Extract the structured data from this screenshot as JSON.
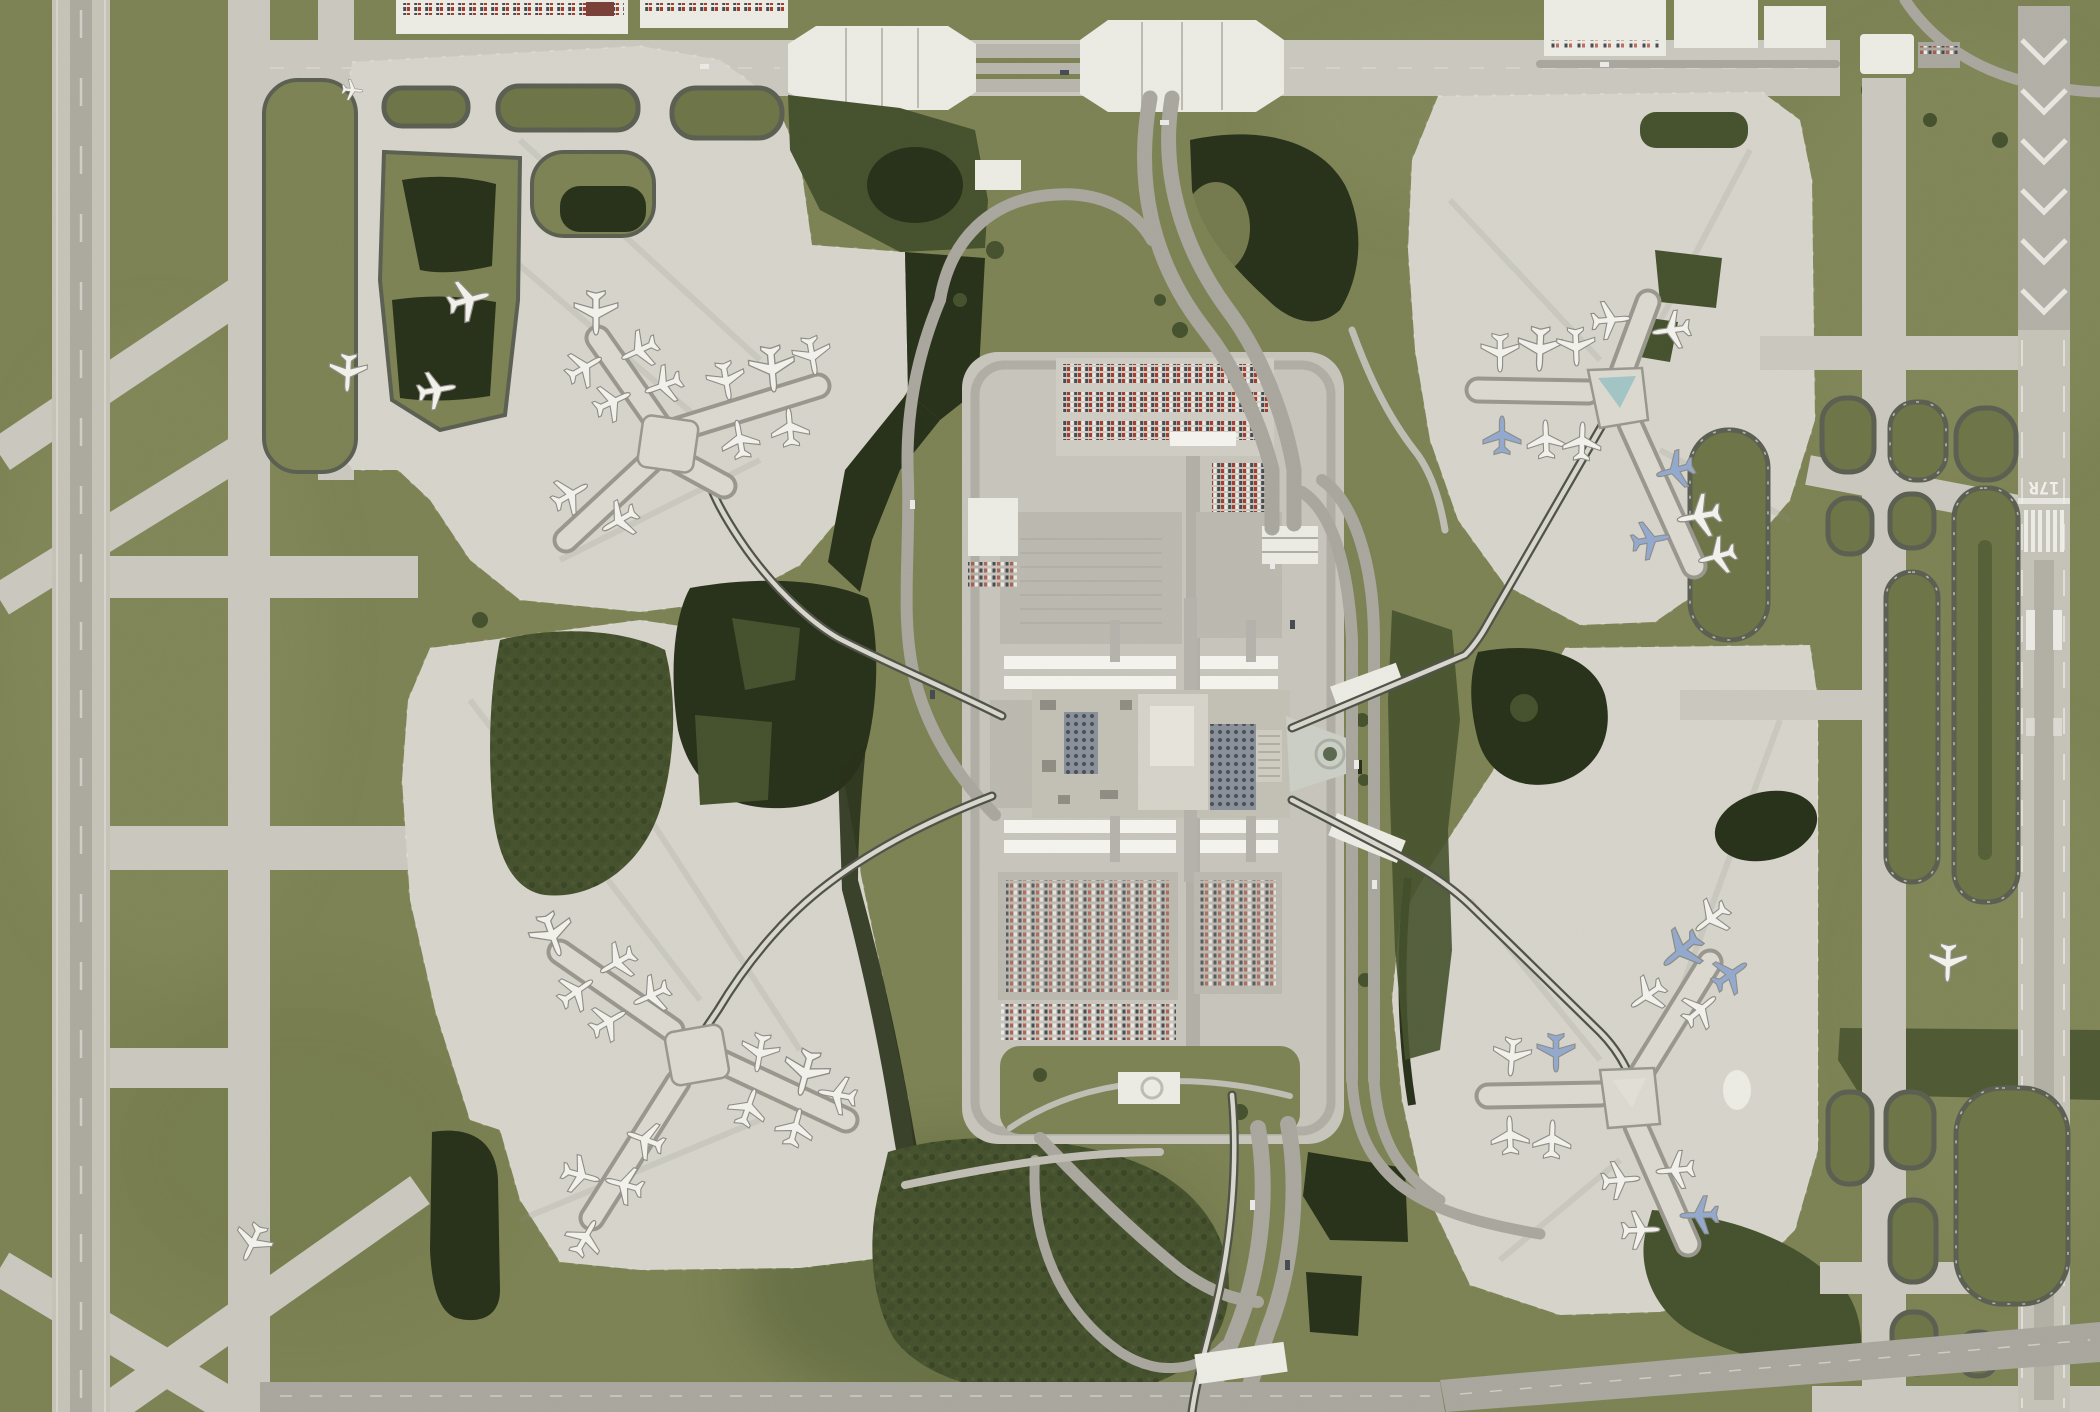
{
  "meta": {
    "title": "Satellite orthophoto — large hub airport",
    "type": "aerial-photograph",
    "description": "Top-down satellite view of an international airport: central landside terminal with parking garages, four satellite airside concourses linked by automated people-mover bridges, parallel north-south runways on the west and east sides, taxiway loops, retention ponds and tree stands."
  },
  "markings": {
    "runway_number_right": "17R"
  },
  "scene": {
    "airside_concourses": 4,
    "monorail_lines": 4,
    "runways_visible": 2,
    "aircraft_visible": 57,
    "features": [
      {
        "name": "runway-west",
        "kind": "runway"
      },
      {
        "name": "runway-east-17R",
        "kind": "runway"
      },
      {
        "name": "taxiway-network-west",
        "kind": "taxiways"
      },
      {
        "name": "taxiway-network-east",
        "kind": "taxiways"
      },
      {
        "name": "airside-northwest",
        "kind": "concourse"
      },
      {
        "name": "airside-northeast",
        "kind": "concourse"
      },
      {
        "name": "airside-southwest",
        "kind": "concourse"
      },
      {
        "name": "airside-southeast",
        "kind": "concourse"
      },
      {
        "name": "central-terminal",
        "kind": "terminal"
      },
      {
        "name": "parking-garages",
        "kind": "parking"
      },
      {
        "name": "rental-car-lots",
        "kind": "parking"
      },
      {
        "name": "taxiway-bridges-north",
        "kind": "bridge"
      },
      {
        "name": "south-access-highway",
        "kind": "road"
      },
      {
        "name": "retention-ponds",
        "kind": "water"
      },
      {
        "name": "tree-stands",
        "kind": "vegetation"
      },
      {
        "name": "cargo-aprons-north",
        "kind": "apron"
      }
    ]
  },
  "palette": {
    "grass": "#7d8354",
    "grass-light": "#8b9162",
    "grass-dark": "#6e7547",
    "tree": "#46522e",
    "tree-dark": "#36421f",
    "water": "#28311a",
    "pavement": "#cbc8bf",
    "apron": "#d6d4cb",
    "pad": "#c7c5bc",
    "pad-light": "#cfcdc4",
    "runway": "#c6c3b9",
    "pavement-old": "#b3b1a7",
    "road": "#a9a79e",
    "road-light": "#c0beb5",
    "streak": "#8f8c81",
    "white-struct": "#ecebe4",
    "canopy": "#f4f3ed",
    "terminal": "#c3c1b6",
    "garage": "#bcbab0",
    "dark-grid": "#4b525a",
    "grid-base": "#8b919a",
    "teal": "#a2c5c6",
    "plaza": "#cccfc5",
    "fountain": "#5c6a50",
    "ring-dark": "#5c6052",
    "rail-dark": "#4f5348",
    "rail-light": "#d9d7ce",
    "concourse": "#dcdad0",
    "concourse-edge": "#9a988e",
    "plane": "#f2f1ec",
    "plane-outline": "#8e8d85",
    "plane-blue": "#93a9cf",
    "car-red": "#a83b2c",
    "car-white": "#eceae6",
    "car-dark": "#474b52",
    "marking-white": "#f5f4ef"
  }
}
